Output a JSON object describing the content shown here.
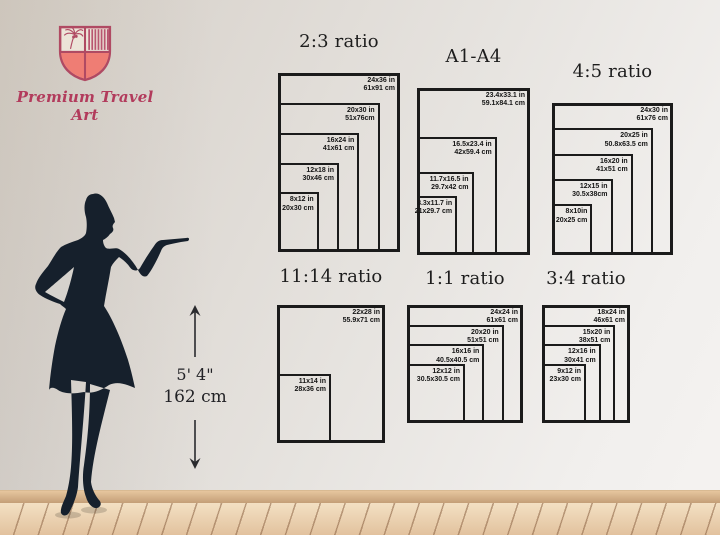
{
  "brand": {
    "name": "Premium Travel Art",
    "accent": "#b23b5c",
    "shield_fill": "#ef7d74",
    "shield_stroke": "#b04a63"
  },
  "height_indicator": {
    "imperial": "5' 4\"",
    "metric": "162 cm"
  },
  "chart_data": [
    {
      "id": "ratio-2-3",
      "type": "nested-rectangles",
      "title": "2:3 ratio",
      "anchor": "bottom-left",
      "sizes": [
        {
          "label_in": "24x36 in",
          "label_cm": "61x91 cm",
          "w_in": 24,
          "h_in": 36
        },
        {
          "label_in": "20x30 in",
          "label_cm": "51x76cm",
          "w_in": 20,
          "h_in": 30
        },
        {
          "label_in": "16x24 in",
          "label_cm": "41x61 cm",
          "w_in": 16,
          "h_in": 24
        },
        {
          "label_in": "12x18 in",
          "label_cm": "30x46 cm",
          "w_in": 12,
          "h_in": 18
        },
        {
          "label_in": "8x12 in",
          "label_cm": "20x30 cm",
          "w_in": 8,
          "h_in": 12
        }
      ]
    },
    {
      "id": "a1-a4",
      "type": "nested-rectangles",
      "title": "A1-A4",
      "anchor": "bottom-left",
      "sizes": [
        {
          "label_in": "23.4x33.1 in",
          "label_cm": "59.1x84.1 cm",
          "w_in": 23.4,
          "h_in": 33.1
        },
        {
          "label_in": "16.5x23.4 in",
          "label_cm": "42x59.4 cm",
          "w_in": 16.5,
          "h_in": 23.4
        },
        {
          "label_in": "11.7x16.5 in",
          "label_cm": "29.7x42 cm",
          "w_in": 11.7,
          "h_in": 16.5
        },
        {
          "label_in": "8.3x11.7 in",
          "label_cm": "21x29.7 cm",
          "w_in": 8.3,
          "h_in": 11.7
        }
      ]
    },
    {
      "id": "ratio-4-5",
      "type": "nested-rectangles",
      "title": "4:5 ratio",
      "anchor": "bottom-left",
      "sizes": [
        {
          "label_in": "24x30 in",
          "label_cm": "61x76 cm",
          "w_in": 24,
          "h_in": 30
        },
        {
          "label_in": "20x25 in",
          "label_cm": "50.8x63.5 cm",
          "w_in": 20,
          "h_in": 25
        },
        {
          "label_in": "16x20 in",
          "label_cm": "41x51 cm",
          "w_in": 16,
          "h_in": 20
        },
        {
          "label_in": "12x15 in",
          "label_cm": "30.5x38cm",
          "w_in": 12,
          "h_in": 15
        },
        {
          "label_in": "8x10in",
          "label_cm": "20x25 cm",
          "w_in": 8,
          "h_in": 10
        }
      ]
    },
    {
      "id": "ratio-11-14",
      "type": "nested-rectangles",
      "title": "11:14 ratio",
      "anchor": "bottom-left",
      "sizes": [
        {
          "label_in": "22x28 in",
          "label_cm": "55.9x71 cm",
          "w_in": 22,
          "h_in": 28
        },
        {
          "label_in": "11x14 in",
          "label_cm": "28x36 cm",
          "w_in": 11,
          "h_in": 14
        }
      ]
    },
    {
      "id": "ratio-1-1",
      "type": "nested-rectangles",
      "title": "1:1 ratio",
      "anchor": "bottom-left",
      "sizes": [
        {
          "label_in": "24x24 in",
          "label_cm": "61x61 cm",
          "w_in": 24,
          "h_in": 24
        },
        {
          "label_in": "20x20 in",
          "label_cm": "51x51 cm",
          "w_in": 20,
          "h_in": 20
        },
        {
          "label_in": "16x16 in",
          "label_cm": "40.5x40.5 cm",
          "w_in": 16,
          "h_in": 16
        },
        {
          "label_in": "12x12 in",
          "label_cm": "30.5x30.5 cm",
          "w_in": 12,
          "h_in": 12
        }
      ]
    },
    {
      "id": "ratio-3-4",
      "type": "nested-rectangles",
      "title": "3:4 ratio",
      "anchor": "bottom-left",
      "sizes": [
        {
          "label_in": "18x24 in",
          "label_cm": "46x61 cm",
          "w_in": 18,
          "h_in": 24
        },
        {
          "label_in": "15x20 in",
          "label_cm": "38x51 cm",
          "w_in": 15,
          "h_in": 20
        },
        {
          "label_in": "12x16 in",
          "label_cm": "30x41 cm",
          "w_in": 12,
          "h_in": 16
        },
        {
          "label_in": "9x12 in",
          "label_cm": "23x30 cm",
          "w_in": 9,
          "h_in": 12
        }
      ]
    }
  ]
}
